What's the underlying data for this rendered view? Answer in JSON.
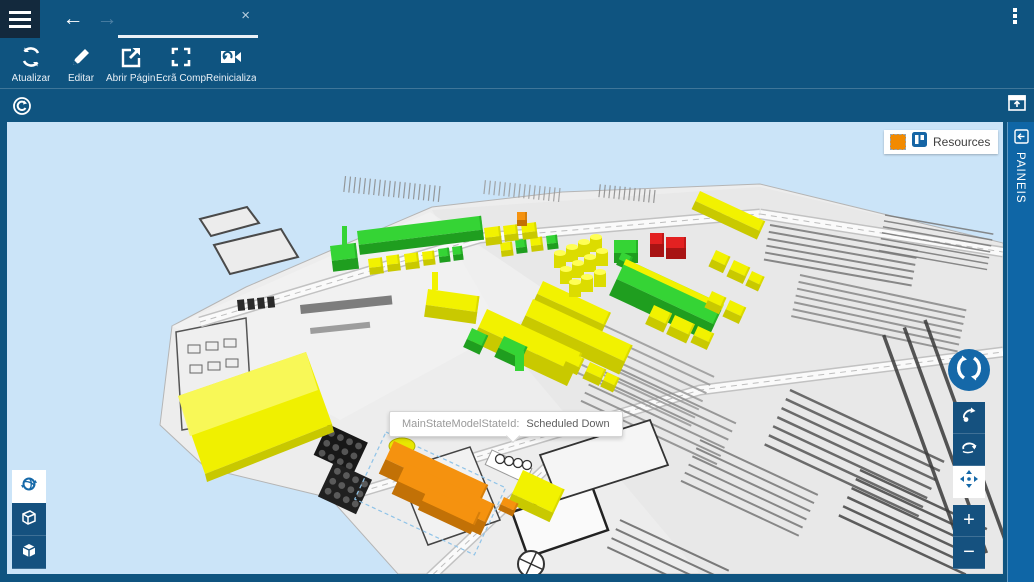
{
  "topbar": {
    "back_arrow": "←",
    "forward_arrow": "→",
    "tab_title": "",
    "tab_close": "×"
  },
  "toolbar": {
    "buttons": [
      {
        "id": "atualizar",
        "label": "Atualizar",
        "icon": "refresh-icon"
      },
      {
        "id": "editar",
        "label": "Editar",
        "icon": "pencil-icon"
      },
      {
        "id": "abrir-pagina",
        "label": "Abrir Págin...",
        "icon": "open-external-icon"
      },
      {
        "id": "ecra-completo",
        "label": "Ecrã Compl...",
        "icon": "fullscreen-icon"
      },
      {
        "id": "reinicializar",
        "label": "Reinicializar...",
        "icon": "reset-camera-icon"
      }
    ]
  },
  "side_panel": {
    "label": "PAINEIS"
  },
  "legend": {
    "title": "Resources",
    "swatch_color": "#F28A00"
  },
  "tooltip": {
    "label": "MainStateModelStateId:",
    "value": "Scheduled Down"
  },
  "view_controls": {
    "zoom_in": "+",
    "zoom_out": "−"
  },
  "colors": {
    "topbar": "#0F5480",
    "hamburger_bg": "#13293D",
    "strip": "#0F66A6",
    "accent": "#1568A8",
    "sky": "#CBE4F8",
    "ground": "#EDEDED",
    "status": {
      "green": {
        "top": "#35D435",
        "front": "#1F9E1F"
      },
      "yellow": {
        "top": "#F2F200",
        "front": "#C9C900"
      },
      "orange": {
        "top": "#F5920F",
        "front": "#C27106"
      },
      "red": {
        "top": "#E32121",
        "front": "#A81414"
      }
    }
  },
  "scene": {
    "ground_main": [
      [
        160,
        425
      ],
      [
        172,
        326
      ],
      [
        246,
        287
      ],
      [
        334,
        249
      ],
      [
        432,
        207
      ],
      [
        562,
        192
      ],
      [
        760,
        184
      ],
      [
        1003,
        243
      ],
      [
        1003,
        574
      ],
      [
        398,
        574
      ],
      [
        330,
        498
      ],
      [
        206,
        468
      ]
    ],
    "ground_shades": [
      {
        "pts": [
          [
            432,
            210
          ],
          [
            760,
            187
          ],
          [
            1003,
            244
          ],
          [
            1003,
            574
          ],
          [
            700,
            574
          ],
          [
            520,
            360
          ]
        ],
        "fill": "#E4E4E4",
        "op": 0.55
      },
      {
        "pts": [
          [
            172,
            326
          ],
          [
            430,
            212
          ],
          [
            560,
            300
          ],
          [
            340,
            420
          ]
        ],
        "fill": "#F6F6F6",
        "op": 0.5
      }
    ],
    "islands": [
      {
        "pts": [
          [
            200,
            219
          ],
          [
            247,
            207
          ],
          [
            259,
            223
          ],
          [
            211,
            236
          ]
        ]
      },
      {
        "pts": [
          [
            214,
            245
          ],
          [
            281,
            229
          ],
          [
            298,
            257
          ],
          [
            230,
            274
          ]
        ]
      }
    ],
    "building": {
      "pts": [
        [
          176,
          332
        ],
        [
          246,
          318
        ],
        [
          252,
          418
        ],
        [
          182,
          430
        ]
      ],
      "windows": [
        [
          188,
          345
        ],
        [
          206,
          342
        ],
        [
          224,
          339
        ],
        [
          190,
          365
        ],
        [
          208,
          362
        ],
        [
          226,
          359
        ]
      ]
    },
    "roads": [
      {
        "pts": [
          [
            200,
            322
          ],
          [
            480,
            238
          ],
          [
            760,
            214
          ]
        ]
      },
      {
        "pts": [
          [
            340,
            498
          ],
          [
            700,
            390
          ],
          [
            1003,
            352
          ]
        ]
      },
      {
        "pts": [
          [
            425,
            582
          ],
          [
            560,
            455
          ]
        ]
      },
      {
        "pts": [
          [
            760,
            214
          ],
          [
            1003,
            252
          ]
        ]
      }
    ],
    "hatches": [
      [
        440,
        186,
        96,
        16,
        20,
        5,
        "#8A8A8A",
        1.2
      ],
      [
        560,
        188,
        96,
        14,
        16,
        5,
        "#999999",
        1.2
      ],
      [
        655,
        190,
        96,
        13,
        12,
        5,
        "#8A8A8A",
        1.2
      ],
      [
        770,
        225,
        10,
        150,
        6,
        7,
        "#777777",
        2
      ],
      [
        800,
        275,
        12,
        170,
        7,
        7,
        "#888888",
        2
      ],
      [
        885,
        215,
        10,
        110,
        7,
        6,
        "#777777",
        1.5
      ],
      [
        560,
        305,
        25,
        170,
        7,
        9,
        "#999999",
        2
      ],
      [
        600,
        360,
        25,
        150,
        6,
        9,
        "#8A8A8A",
        2
      ],
      [
        790,
        390,
        25,
        170,
        7,
        10,
        "#555555",
        2.5
      ],
      [
        860,
        470,
        25,
        140,
        6,
        10,
        "#444444",
        2.5
      ],
      [
        700,
        440,
        25,
        130,
        6,
        9,
        "#777777",
        2
      ],
      [
        925,
        320,
        70,
        240,
        3,
        22,
        "#3A3A3A",
        3.5
      ],
      [
        620,
        520,
        25,
        120,
        4,
        10,
        "#666666",
        2
      ]
    ],
    "bars": [
      [
        237,
        300,
        7,
        11,
        -6,
        "#2A2A2A",
        1
      ],
      [
        247,
        299,
        7,
        11,
        -6,
        "#2A2A2A",
        1
      ],
      [
        257,
        298,
        7,
        11,
        -6,
        "#2A2A2A",
        1
      ],
      [
        267,
        297,
        7,
        11,
        -6,
        "#2A2A2A",
        1
      ],
      [
        300,
        305,
        92,
        9,
        -6,
        "#555555",
        0.75
      ],
      [
        310,
        328,
        60,
        6,
        -6,
        "#666666",
        0.6
      ]
    ],
    "rooms": [
      {
        "pts": [
          [
            512,
            512
          ],
          [
            592,
            486
          ],
          [
            608,
            530
          ],
          [
            528,
            557
          ]
        ],
        "stroke": "#222222",
        "w": 2.5,
        "fill": "#FAFAFA"
      },
      {
        "pts": [
          [
            540,
            455
          ],
          [
            650,
            420
          ],
          [
            668,
            465
          ],
          [
            558,
            500
          ]
        ],
        "stroke": "#333333",
        "w": 1.8,
        "fill": "#F5F5F5"
      },
      {
        "pts": [
          [
            398,
            470
          ],
          [
            470,
            447
          ],
          [
            500,
            520
          ],
          [
            428,
            545
          ]
        ],
        "stroke": "#444444",
        "w": 1.5,
        "fill": "#F2F2F2"
      }
    ],
    "crates": [
      {
        "x": 328,
        "y": 424,
        "w": 44,
        "h": 34,
        "a": 25,
        "fill": "#181818",
        "dot": "#555555"
      },
      {
        "x": 334,
        "y": 462,
        "w": 42,
        "h": 38,
        "a": 25,
        "fill": "#202020",
        "dot": "#5A5A5A"
      }
    ],
    "circle_row": {
      "strip": [
        492,
        450,
        44,
        16,
        25
      ],
      "circles": [
        [
          500,
          459
        ],
        [
          509,
          461
        ],
        [
          518,
          463
        ],
        [
          527,
          465
        ]
      ]
    },
    "wheel": {
      "cx": 531,
      "cy": 564,
      "r": 13
    },
    "slab": {
      "main": [
        [
          178,
          396
        ],
        [
          306,
          352
        ],
        [
          332,
          424
        ],
        [
          205,
          474
        ]
      ],
      "light": [
        [
          178,
          396
        ],
        [
          306,
          352
        ],
        [
          318,
          390
        ],
        [
          190,
          436
        ]
      ],
      "edge": [
        [
          205,
          474
        ],
        [
          332,
          424
        ],
        [
          334,
          432
        ],
        [
          207,
          482
        ]
      ]
    },
    "selection_box": {
      "x": 386,
      "y": 432,
      "w": 132,
      "h": 74,
      "a": 25
    },
    "blocks": [
      [
        330,
        246,
        26,
        15,
        11,
        -7,
        "green"
      ],
      [
        357,
        231,
        125,
        14,
        10,
        -7,
        "green"
      ],
      [
        342,
        226,
        5,
        22,
        0,
        0,
        "green"
      ],
      [
        368,
        259,
        14,
        9,
        7,
        -7,
        "yellow"
      ],
      [
        386,
        256,
        13,
        9,
        7,
        -7,
        "yellow"
      ],
      [
        404,
        254,
        14,
        9,
        7,
        -7,
        "yellow"
      ],
      [
        422,
        252,
        12,
        8,
        6,
        -7,
        "yellow"
      ],
      [
        438,
        249,
        11,
        8,
        6,
        -7,
        "green"
      ],
      [
        452,
        247,
        10,
        8,
        6,
        -7,
        "green"
      ],
      [
        500,
        243,
        12,
        8,
        6,
        -7,
        "yellow"
      ],
      [
        515,
        240,
        11,
        8,
        6,
        -7,
        "green"
      ],
      [
        530,
        238,
        12,
        8,
        6,
        -7,
        "yellow"
      ],
      [
        546,
        236,
        11,
        8,
        6,
        -7,
        "green"
      ],
      [
        484,
        228,
        16,
        10,
        8,
        -7,
        "yellow"
      ],
      [
        503,
        226,
        14,
        9,
        7,
        -7,
        "yellow"
      ],
      [
        521,
        224,
        15,
        9,
        7,
        -7,
        "yellow"
      ],
      [
        517,
        212,
        10,
        8,
        6,
        0,
        "orange"
      ],
      [
        700,
        191,
        72,
        11,
        9,
        25,
        "yellow"
      ],
      [
        650,
        233,
        14,
        11,
        13,
        0,
        "red"
      ],
      [
        666,
        237,
        20,
        11,
        11,
        0,
        "red"
      ],
      [
        614,
        240,
        24,
        13,
        10,
        0,
        "green"
      ],
      [
        622,
        252,
        12,
        8,
        6,
        25,
        "green"
      ],
      [
        626,
        259,
        108,
        22,
        18,
        25,
        "green"
      ],
      [
        626,
        259,
        108,
        6,
        0,
        25,
        "yellow"
      ],
      [
        712,
        291,
        16,
        10,
        8,
        25,
        "yellow"
      ],
      [
        730,
        300,
        18,
        10,
        8,
        25,
        "yellow"
      ],
      [
        543,
        281,
        75,
        14,
        11,
        25,
        "yellow"
      ],
      [
        533,
        299,
        110,
        18,
        14,
        25,
        "yellow"
      ],
      [
        487,
        309,
        105,
        20,
        16,
        25,
        "yellow"
      ],
      [
        428,
        289,
        52,
        16,
        12,
        8,
        "yellow"
      ],
      [
        432,
        272,
        6,
        18,
        0,
        0,
        "yellow"
      ],
      [
        472,
        328,
        18,
        12,
        9,
        25,
        "green"
      ],
      [
        504,
        336,
        26,
        13,
        10,
        25,
        "green"
      ],
      [
        515,
        351,
        9,
        20,
        0,
        0,
        "green"
      ],
      [
        570,
        352,
        16,
        10,
        8,
        25,
        "yellow"
      ],
      [
        590,
        362,
        18,
        10,
        8,
        25,
        "yellow"
      ],
      [
        607,
        372,
        14,
        9,
        7,
        25,
        "yellow"
      ],
      [
        654,
        305,
        20,
        12,
        9,
        25,
        "yellow"
      ],
      [
        675,
        315,
        22,
        12,
        9,
        25,
        "yellow"
      ],
      [
        698,
        326,
        18,
        10,
        8,
        25,
        "yellow"
      ],
      [
        716,
        250,
        16,
        10,
        8,
        25,
        "yellow"
      ],
      [
        734,
        260,
        18,
        10,
        8,
        25,
        "yellow"
      ],
      [
        752,
        271,
        14,
        9,
        7,
        25,
        "yellow"
      ],
      [
        523,
        470,
        46,
        26,
        10,
        25,
        "yellow"
      ],
      [
        394,
        441,
        104,
        20,
        16,
        25,
        "orange"
      ],
      [
        406,
        463,
        98,
        20,
        14,
        25,
        "orange"
      ],
      [
        428,
        488,
        58,
        14,
        10,
        25,
        "orange"
      ],
      [
        504,
        497,
        16,
        8,
        6,
        25,
        "orange"
      ]
    ],
    "cylinders": [
      [
        560,
        268
      ],
      [
        572,
        262
      ],
      [
        584,
        257
      ],
      [
        596,
        252
      ],
      [
        566,
        284
      ],
      [
        578,
        278
      ],
      [
        590,
        272
      ],
      [
        602,
        266
      ],
      [
        575,
        297
      ],
      [
        587,
        292
      ],
      [
        600,
        287
      ]
    ],
    "blob": {
      "cx": 402,
      "cy": 446,
      "rx": 13,
      "ry": 8
    }
  }
}
